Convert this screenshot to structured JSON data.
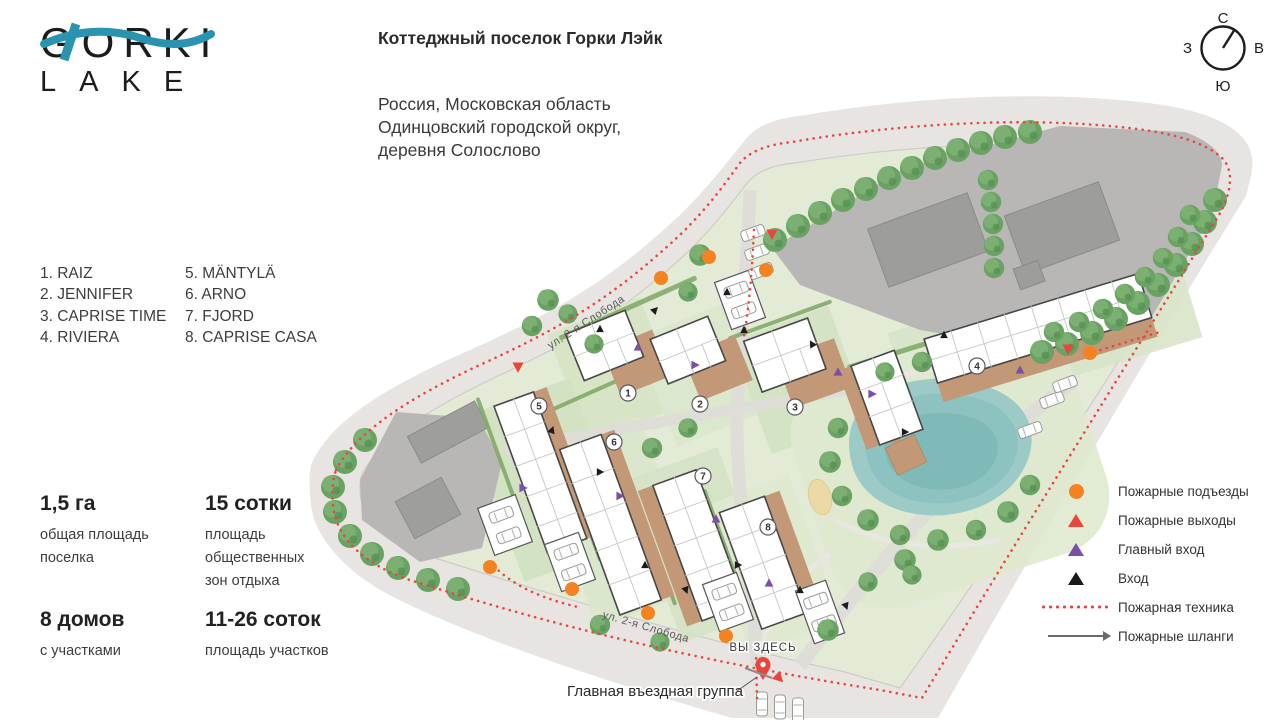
{
  "logo": {
    "line1": "GORKI",
    "line2": "LAKE",
    "wave_color": "#2a93af"
  },
  "header": {
    "title": "Коттеджный поселок Горки Лэйк",
    "address_line1": "Россия, Московская область",
    "address_line2": "Одинцовский городской округ,",
    "address_line3": "деревня Солослово"
  },
  "houses": [
    {
      "num": "1",
      "name": "RAIZ",
      "list_label": "1. RAIZ"
    },
    {
      "num": "2",
      "name": "JENNIFER",
      "list_label": "2. JENNIFER"
    },
    {
      "num": "3",
      "name": "CAPRISE TIME",
      "list_label": "3. CAPRISE TIME"
    },
    {
      "num": "4",
      "name": "RIVIERA",
      "list_label": "4. RIVIERA"
    },
    {
      "num": "5",
      "name": "MÄNTYLÄ",
      "list_label": "5. MÄNTYLÄ"
    },
    {
      "num": "6",
      "name": "ARNO",
      "list_label": "6. ARNO"
    },
    {
      "num": "7",
      "name": "FJORD",
      "list_label": "7. FJORD"
    },
    {
      "num": "8",
      "name": "CAPRISE CASA",
      "list_label": "8. CAPRISE CASA"
    }
  ],
  "stats": [
    {
      "value": "1,5 га",
      "line1": "общая площадь",
      "line2": "поселка",
      "line3": ""
    },
    {
      "value": "15 сотки",
      "line1": "площадь",
      "line2": "общественных",
      "line3": "зон отдыха"
    },
    {
      "value": "8 домов",
      "line1": "с участками",
      "line2": "",
      "line3": ""
    },
    {
      "value": "11-26 соток",
      "line1": "площадь участков",
      "line2": "",
      "line3": ""
    }
  ],
  "legend": {
    "items": [
      {
        "icon": "fire-access-circle",
        "color": "#f58220",
        "label": "Пожарные подъезды"
      },
      {
        "icon": "fire-exit-triangle",
        "color": "#e8453c",
        "label": "Пожарные выходы"
      },
      {
        "icon": "main-entrance-triangle",
        "color": "#7b4fa6",
        "label": "Главный вход"
      },
      {
        "icon": "entrance-triangle",
        "color": "#1a1a1a",
        "label": "Вход"
      },
      {
        "icon": "fire-truck-dotted-line",
        "color": "#e8473f",
        "label": "Пожарная техника"
      },
      {
        "icon": "fire-hose-arrow",
        "color": "#6a6a6a",
        "label": "Пожарные шланги"
      }
    ]
  },
  "compass": {
    "north": "С",
    "south": "Ю",
    "west": "З",
    "east": "В"
  },
  "map_labels": {
    "street_upper": "ул. 2-я Слобода",
    "street_lower": "ул. 2-я Слобода",
    "you_are_here": "ВЫ ЗДЕСЬ",
    "main_entrance": "Главная въездная группа"
  }
}
